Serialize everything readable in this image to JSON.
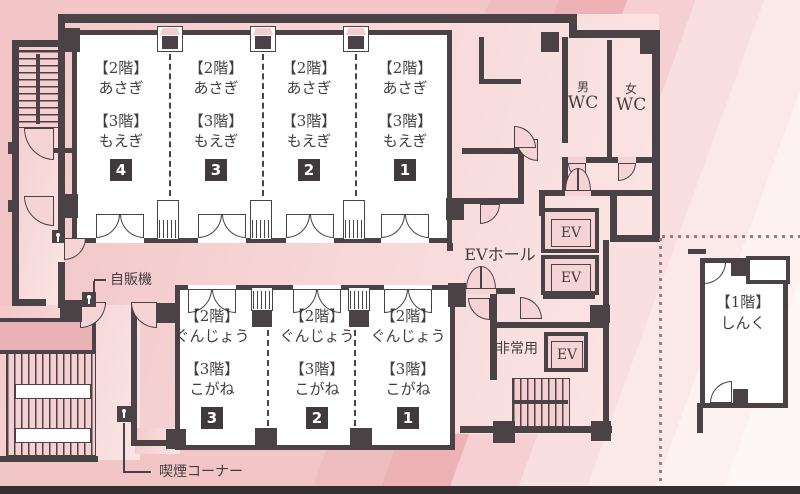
{
  "colors": {
    "wall": "#4a4245",
    "floor": "#f6d4d5",
    "room_white": "#ffffff",
    "boundary_dot": "#a1767b"
  },
  "top_rooms": [
    {
      "floor2_tag": "【2階】",
      "floor2_name": "あさぎ",
      "floor3_tag": "【3階】",
      "floor3_name": "もえぎ",
      "number": "4"
    },
    {
      "floor2_tag": "【2階】",
      "floor2_name": "あさぎ",
      "floor3_tag": "【3階】",
      "floor3_name": "もえぎ",
      "number": "3"
    },
    {
      "floor2_tag": "【2階】",
      "floor2_name": "あさぎ",
      "floor3_tag": "【3階】",
      "floor3_name": "もえぎ",
      "number": "2"
    },
    {
      "floor2_tag": "【2階】",
      "floor2_name": "あさぎ",
      "floor3_tag": "【3階】",
      "floor3_name": "もえぎ",
      "number": "1"
    }
  ],
  "bottom_rooms": [
    {
      "floor2_tag": "【2階】",
      "floor2_name": "ぐんじょう",
      "floor3_tag": "【3階】",
      "floor3_name": "こがね",
      "number": "3"
    },
    {
      "floor2_tag": "【2階】",
      "floor2_name": "ぐんじょう",
      "floor3_tag": "【3階】",
      "floor3_name": "こがね",
      "number": "2"
    },
    {
      "floor2_tag": "【2階】",
      "floor2_name": "ぐんじょう",
      "floor3_tag": "【3階】",
      "floor3_name": "こがね",
      "number": "1"
    }
  ],
  "labels": {
    "mens": "男",
    "womens": "女",
    "wc": "WC",
    "ev_hall": "EVホール",
    "ev": "EV",
    "emergency_use": "非常用",
    "vending_machine": "自販機",
    "smoking_corner": "喫煙コーナー",
    "annex_floor_tag": "【1階】",
    "annex_name": "しんく"
  }
}
